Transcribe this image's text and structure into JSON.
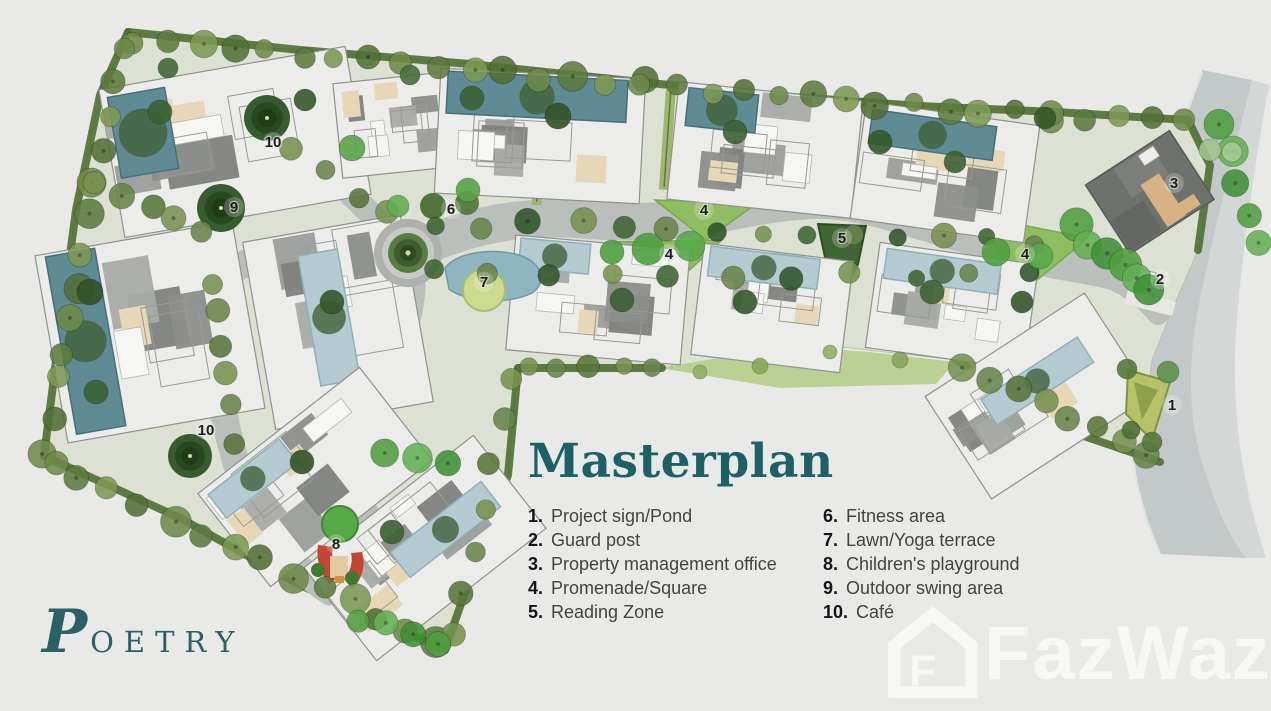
{
  "page": {
    "background": "#e9eae8"
  },
  "title": {
    "text": "Masterplan",
    "color": "#1d6167"
  },
  "legend": {
    "col1": [
      {
        "num": "1.",
        "label": "Project sign/Pond"
      },
      {
        "num": "2.",
        "label": "Guard post"
      },
      {
        "num": "3.",
        "label": "Property management office"
      },
      {
        "num": "4.",
        "label": "Promenade/Square"
      },
      {
        "num": "5.",
        "label": "Reading Zone"
      }
    ],
    "col2": [
      {
        "num": "6.",
        "label": "Fitness area"
      },
      {
        "num": "7.",
        "label": "Lawn/Yoga terrace"
      },
      {
        "num": "8.",
        "label": "Children's playground"
      },
      {
        "num": "9.",
        "label": "Outdoor swing area"
      },
      {
        "num": "10.",
        "label": "Café"
      }
    ]
  },
  "logo": {
    "initial": "P",
    "rest": "OETRY",
    "color": "#2a6166"
  },
  "watermark": {
    "text": "FazWaz"
  },
  "map": {
    "marker_color": "#1e1e1c",
    "markers": [
      {
        "n": "10",
        "x": 273,
        "y": 147
      },
      {
        "n": "9",
        "x": 234,
        "y": 212
      },
      {
        "n": "6",
        "x": 451,
        "y": 214
      },
      {
        "n": "7",
        "x": 484,
        "y": 287
      },
      {
        "n": "4",
        "x": 704,
        "y": 215
      },
      {
        "n": "4",
        "x": 669,
        "y": 259
      },
      {
        "n": "5",
        "x": 842,
        "y": 243
      },
      {
        "n": "4",
        "x": 1025,
        "y": 259
      },
      {
        "n": "3",
        "x": 1174,
        "y": 188
      },
      {
        "n": "2",
        "x": 1160,
        "y": 284
      },
      {
        "n": "1",
        "x": 1172,
        "y": 410
      },
      {
        "n": "10",
        "x": 206,
        "y": 435
      },
      {
        "n": "8",
        "x": 336,
        "y": 549
      }
    ]
  }
}
